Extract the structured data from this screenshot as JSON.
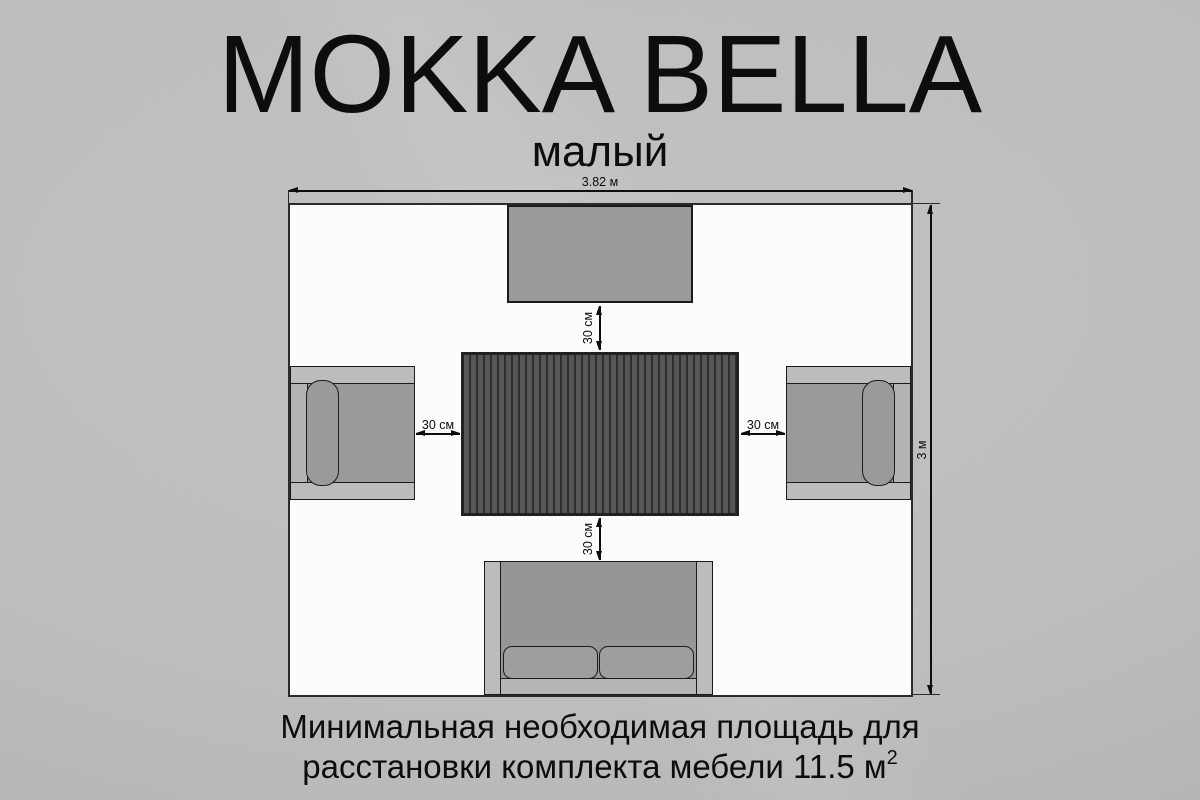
{
  "title": "MOKKA BELLA",
  "subtitle": "малый",
  "plan": {
    "width_label": "3.82 м",
    "height_label": "3 м",
    "clearance_top": "30 см",
    "clearance_bottom": "30 см",
    "clearance_left": "30 см",
    "clearance_right": "30 см"
  },
  "footer": {
    "line1": "Минимальная необходимая площадь для",
    "line2": "расстановки комплекта мебели 11.5 м",
    "superscript": "2"
  },
  "colors": {
    "page_bg": "#c2c2c2",
    "room_fill": "#fcfcfc",
    "wall_line": "#2b2b2b",
    "furniture_fill": "#9a9a9a",
    "furniture_trim": "#bcbcbc",
    "table_slat": "#565656",
    "table_groove": "#2e2e2e",
    "outline": "#1b1b1b",
    "text": "#0d0d0d"
  }
}
